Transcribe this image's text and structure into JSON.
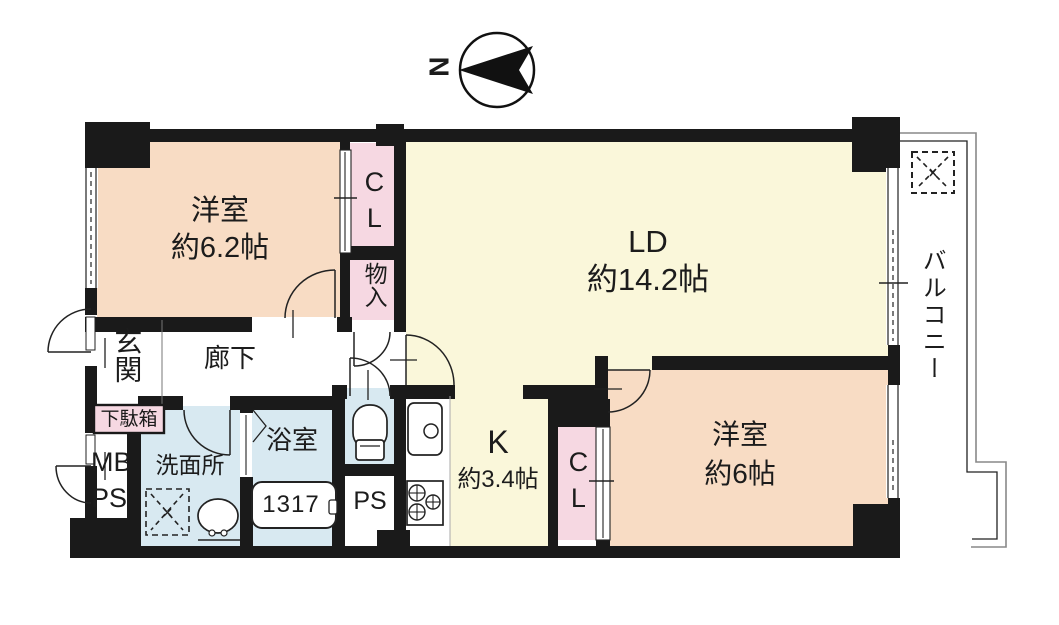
{
  "compass": {
    "label": "N"
  },
  "rooms": {
    "bedroom1": {
      "name": "洋室",
      "size": "約6.2帖"
    },
    "living": {
      "name": "LD",
      "size": "約14.2帖"
    },
    "bedroom2": {
      "name": "洋室",
      "size": "約6帖"
    },
    "kitchen": {
      "name": "K",
      "size": "約3.4帖"
    },
    "closet_top": {
      "name": "CL"
    },
    "closet_bottom": {
      "name": "CL"
    },
    "storage": {
      "name": "物入"
    },
    "entrance": {
      "name": "玄関"
    },
    "shoe_cabinet": {
      "name": "下駄箱"
    },
    "hallway": {
      "name": "廊下"
    },
    "washroom": {
      "name": "洗面所"
    },
    "bathroom": {
      "name": "浴室",
      "bathtub_size": "1317"
    },
    "meter_box": {
      "line1": "MB",
      "line2": "PS"
    },
    "pipe_space": {
      "name": "PS"
    },
    "balcony": {
      "name": "バルコニー"
    }
  },
  "colors": {
    "walls": "#1a1a1a",
    "bedroom_fill": "#f8dcc4",
    "living_kitchen_fill": "#faf7da",
    "closet_fill": "#f6d8e2",
    "wet_area_fill": "#d8e9f1",
    "balcony_outline": "#888888"
  }
}
